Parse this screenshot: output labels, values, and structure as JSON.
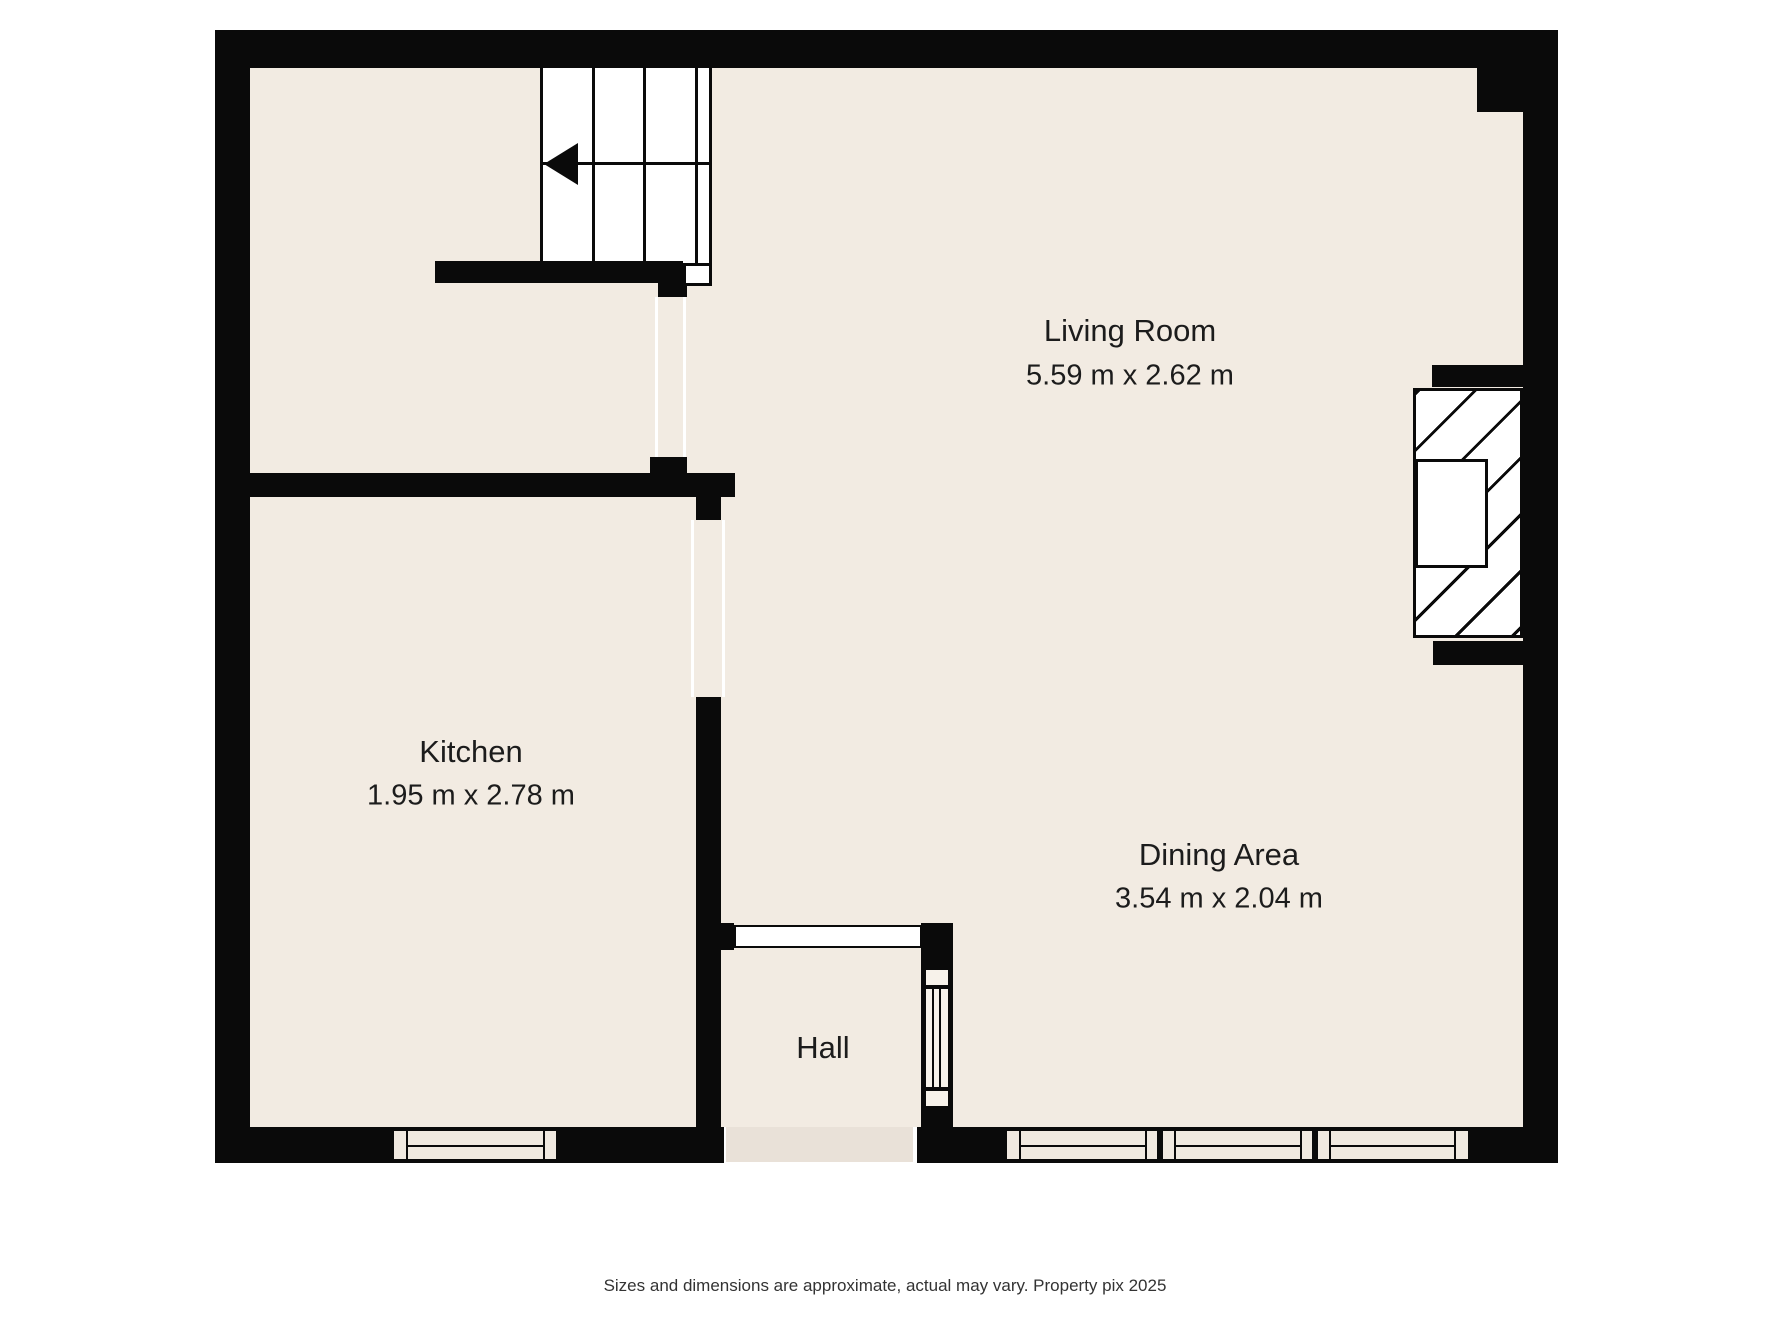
{
  "floorplan": {
    "rooms": [
      {
        "name": "Living Room",
        "dimensions": "5.59 m x 2.62 m"
      },
      {
        "name": "Kitchen",
        "dimensions": "1.95 m x 2.78 m"
      },
      {
        "name": "Dining Area",
        "dimensions": "3.54 m x 2.04 m"
      },
      {
        "name": "Hall",
        "dimensions": ""
      }
    ],
    "features": {
      "stairs": "staircase with down-direction arrow pointing left",
      "fireplace": "hatched chimney breast with recess on right wall",
      "windows": [
        "kitchen window bottom-left",
        "three dining windows bottom-right",
        "glazed panel beside hall"
      ]
    },
    "footer": "Sizes and dimensions are approximate, actual may vary. Property pix 2025",
    "colors": {
      "wall": "#0a0a0a",
      "floor": "#f2ebe2",
      "background": "#ffffff",
      "threshold": "#e9e1d8",
      "text": "#1c1c1c"
    }
  }
}
